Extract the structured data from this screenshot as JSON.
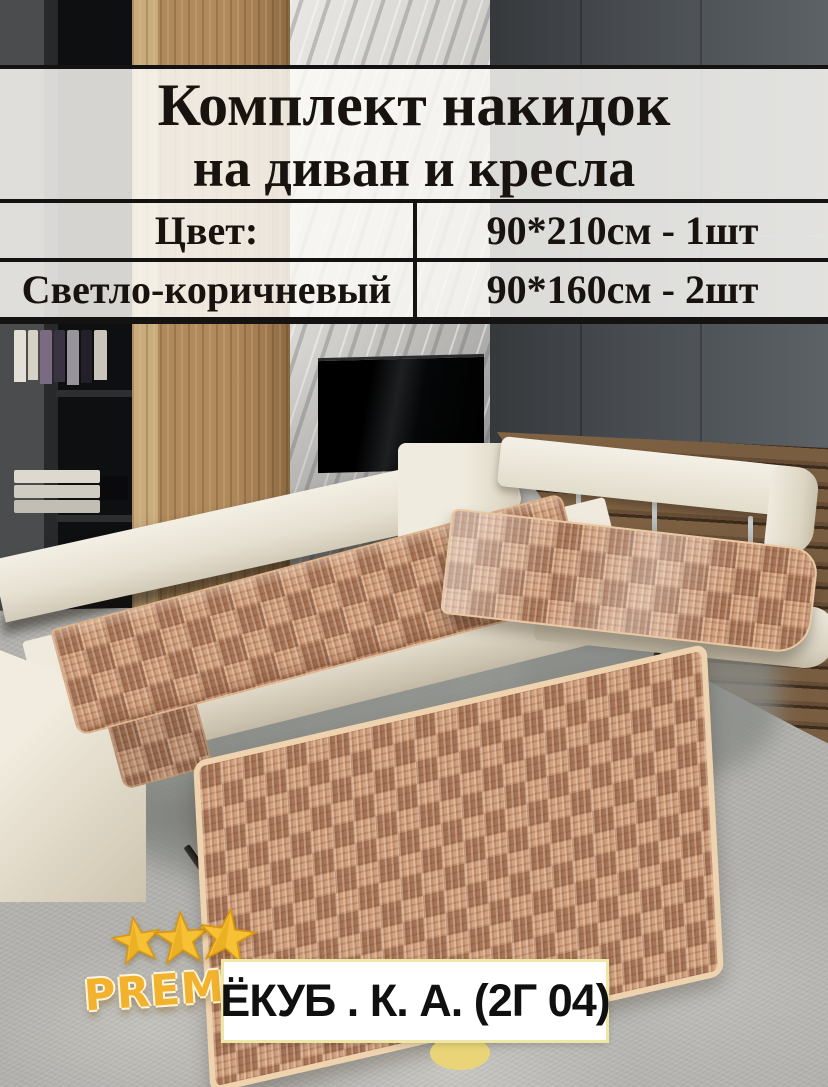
{
  "title": {
    "line1": "Комплект накидок",
    "line2": "на диван и кресла"
  },
  "spec_table": {
    "rows": [
      {
        "left": "Цвет:",
        "right": "90*210см - 1шт"
      },
      {
        "left": "Светло-коричневый",
        "right": "90*160см - 2шт"
      }
    ]
  },
  "branding": {
    "text_fragment": "PREMI",
    "stars_count": 3,
    "icons": {
      "star": "★"
    }
  },
  "seller_label": {
    "text": "ЁКУБ . К. А. (2Г 04)"
  },
  "colors": {
    "overlay_bg": "rgba(252,250,247,0.84)",
    "table_border": "#141312",
    "text": "#18130e",
    "gold": "#f2b22e",
    "label_bg": "#ffffff",
    "label_border": "#efe7a8",
    "cover_brown": "#b5846a",
    "sofa_cream": "#ebe6da",
    "rug_gray": "#b2b1ad",
    "wall_gray": "#484c50",
    "wood_oak": "#a9815a",
    "marble_gray": "#c9c9c6"
  }
}
